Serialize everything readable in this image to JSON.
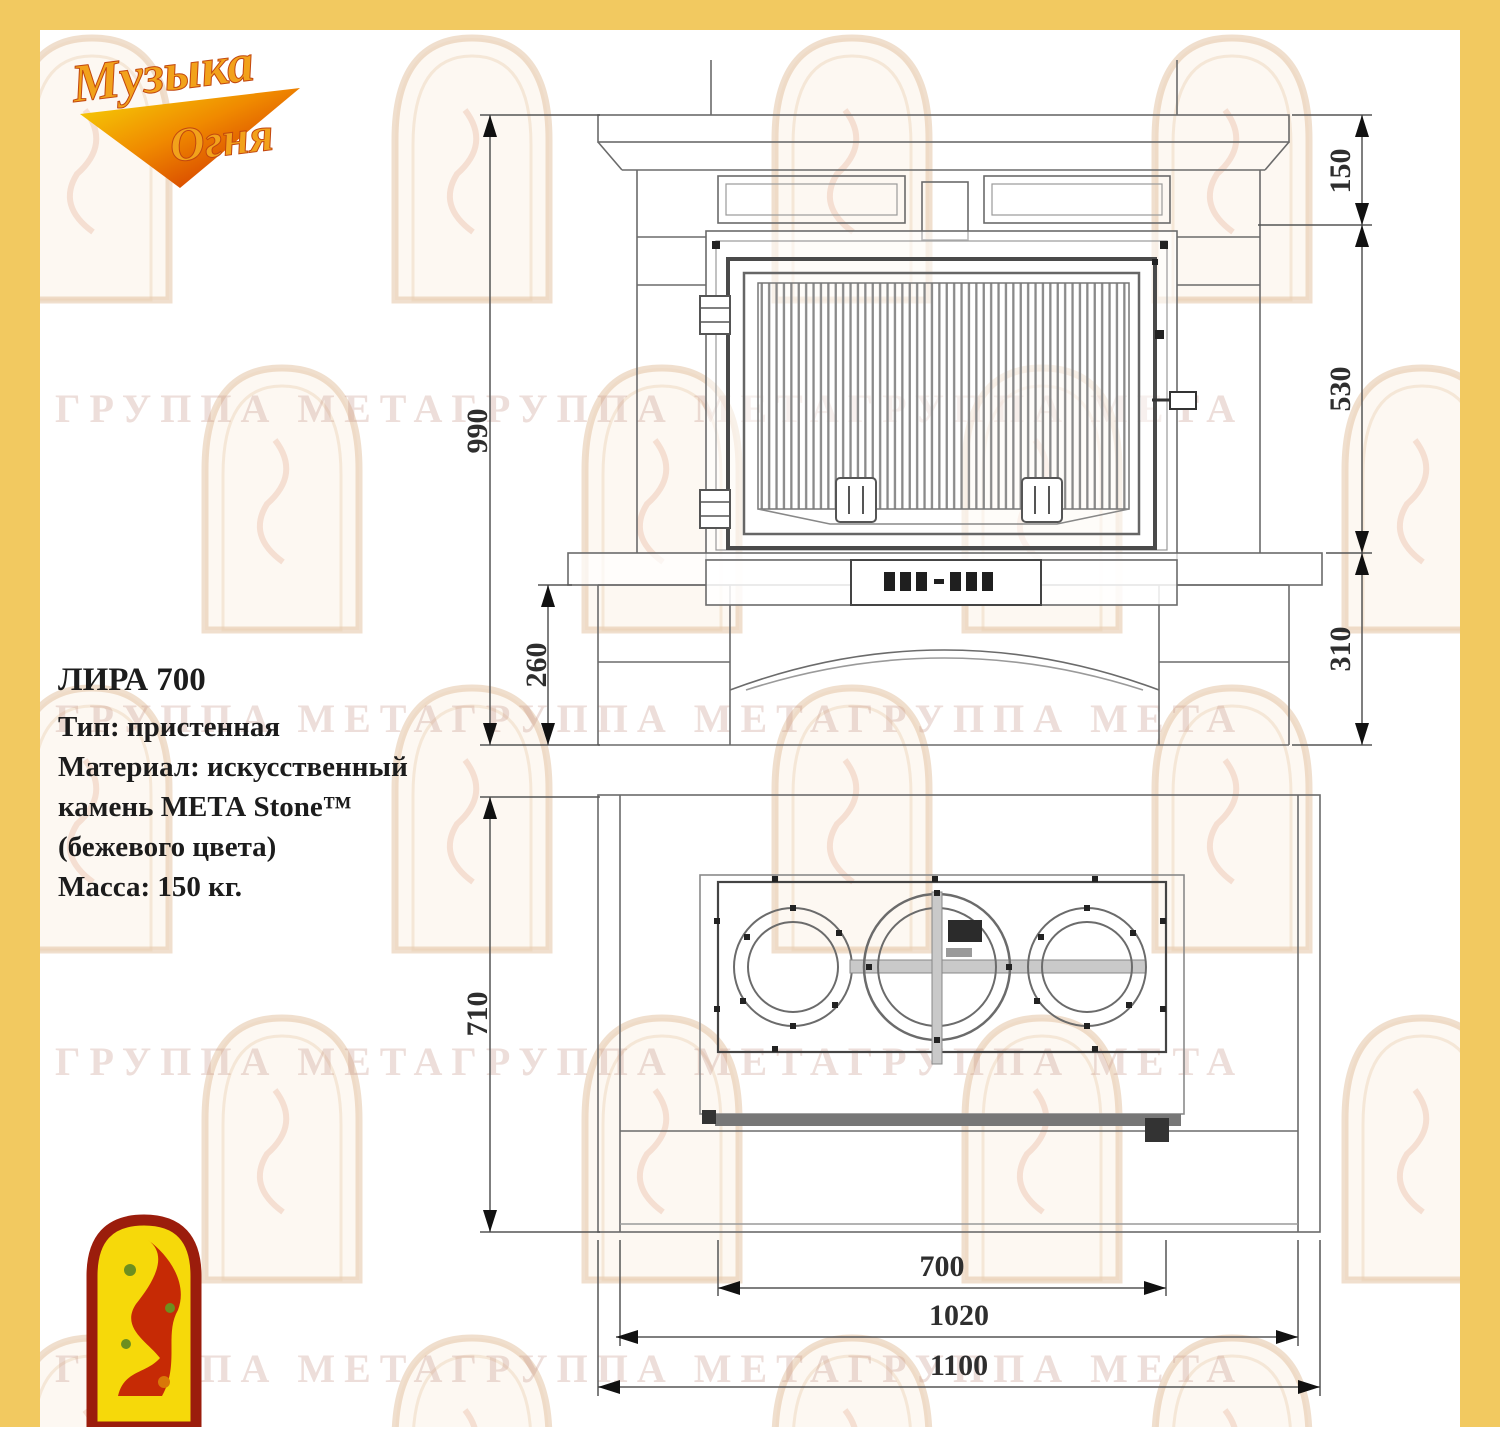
{
  "frame": {
    "color": "#F2C960"
  },
  "brand_logo": {
    "word1": "Музыка",
    "word2": "Огня"
  },
  "product_info": {
    "title": "ЛИРА 700",
    "lines": [
      "Тип: пристенная",
      "Материал: искусственный",
      "камень МЕТА Stone™",
      "(бежевого цвета)",
      "Масса: 150 кг."
    ]
  },
  "watermark": {
    "text": "ГРУППА МЕТАГРУППА МЕТАГРУППА МЕТА"
  },
  "front_view": {
    "dim_total_height": "990",
    "dim_base_height": "260",
    "dim_shelf_height": "150",
    "dim_firebox_height": "530",
    "dim_plinth_height": "310"
  },
  "top_view": {
    "dim_depth": "710",
    "dim_insert_width": "700",
    "dim_inner_width": "1020",
    "dim_total_width": "1100"
  }
}
